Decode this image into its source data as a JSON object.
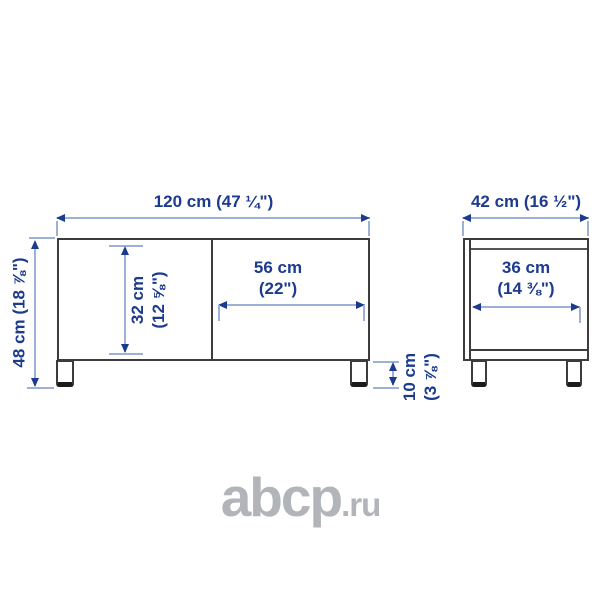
{
  "diagram": {
    "front_view": {
      "width_label": "120 cm (47 ¼\")",
      "height_label": "48 cm (18 ⅞\")",
      "interior_height": {
        "line1": "32 cm",
        "line2": "(12 ⅝\")"
      },
      "door_width": {
        "line1": "56 cm",
        "line2": "(22\")"
      },
      "leg_height": {
        "line1": "10 cm",
        "line2": "(3 ⅞\")"
      }
    },
    "side_view": {
      "depth_label": "42 cm (16 ½\")",
      "interior_depth": {
        "line1": "36 cm",
        "line2": "(14 ⅜\")"
      }
    }
  },
  "watermark": {
    "brand": "abcp",
    "tld": ".ru"
  },
  "colors": {
    "dimension_text": "#1c3a8e",
    "dimension_line": "#9db1d6",
    "outline": "#3c3c3c",
    "watermark": "#b1b4b8"
  }
}
